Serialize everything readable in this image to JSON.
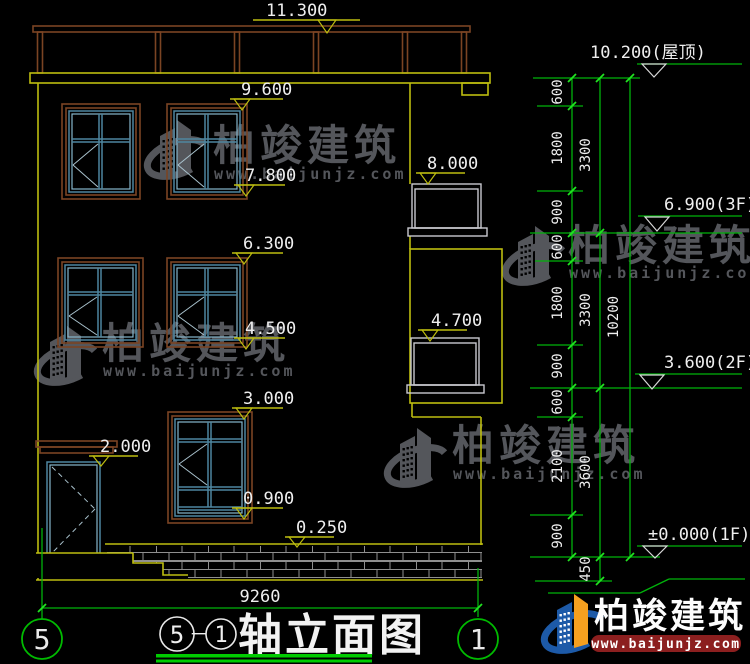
{
  "drawing": {
    "type": "architectural-elevation",
    "sheet_title": "轴立面图",
    "bottom_width_dim": "9260"
  },
  "flags_left": [
    {
      "name": "parapet-top",
      "value": "11.300"
    },
    {
      "name": "3f-window-top",
      "value": "9.600"
    },
    {
      "name": "3f-window-sill",
      "value": "7.800"
    },
    {
      "name": "3f-balcony-rail",
      "value": "8.000"
    },
    {
      "name": "2f-window-top",
      "value": "6.300"
    },
    {
      "name": "2f-window-sill",
      "value": "4.500"
    },
    {
      "name": "2f-balcony-rail",
      "value": "4.700"
    },
    {
      "name": "1f-window-top",
      "value": "3.000"
    },
    {
      "name": "door-canopy",
      "value": "2.000"
    },
    {
      "name": "1f-window-sill",
      "value": "0.900"
    },
    {
      "name": "plinth-top",
      "value": "0.250"
    }
  ],
  "flags_right": [
    {
      "name": "roof-level",
      "value": "10.200(屋顶)"
    },
    {
      "name": "floor-3",
      "value": "6.900(3F)"
    },
    {
      "name": "floor-2",
      "value": "3.600(2F)"
    },
    {
      "name": "floor-1",
      "value": "±0.000(1F)"
    }
  ],
  "dim_chain": {
    "col1": [
      "600",
      "1800",
      "900",
      "600",
      "1800",
      "900",
      "600",
      "2100",
      "900"
    ],
    "col2": [
      "3300",
      "3300",
      "3600",
      "450"
    ],
    "col3": [
      "10200"
    ],
    "bottom": "9260"
  },
  "axis_bubbles": {
    "left": "5",
    "right": "1"
  },
  "title_block": {
    "start_axis": "5",
    "separator": "－",
    "end_axis": "1",
    "name": "轴立面图"
  },
  "watermark": {
    "brand": "柏竣建筑",
    "website": "www.baijunjz.com"
  },
  "footer_logo": {
    "brand": "柏竣建筑",
    "website": "www.baijunjz.com"
  },
  "colors": {
    "background": "#000000",
    "outline_yellow": "#bdbd10",
    "dimension_green": "#00b30b",
    "tick_green": "#21e421",
    "frame_brown": "#7b4423",
    "window_teal": "#4e86a0",
    "railing_gray": "#c9c9cf",
    "text_white": "#efefef",
    "watermark_gray": "#54565b",
    "logo_blue": "#1d5aa8",
    "logo_orange": "#f6a01f",
    "url_box_red": "#8c1f1f",
    "underline_green": "#00cc00"
  }
}
